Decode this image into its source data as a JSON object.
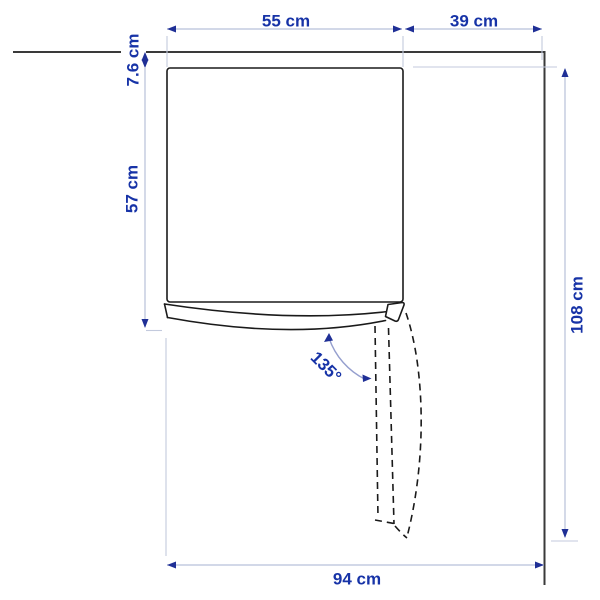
{
  "diagram": {
    "type": "appliance-top-view-dimension-drawing",
    "labels": {
      "body_width": "55 cm",
      "right_clearance": "39 cm",
      "wall_gap": "7.6 cm",
      "body_depth": "57 cm",
      "total_depth": "108 cm",
      "total_width": "94 cm",
      "door_opening_angle": "135°"
    },
    "colors": {
      "label_text": "#1733a7",
      "dimension_line": "#b7c0d9",
      "extension_line": "#c3cadd",
      "arrowhead": "#1f2f96",
      "drawing_line": "#1a1a1a",
      "wall_line": "#3a3a3a",
      "swing_arc": "#959fce",
      "background": "#ffffff"
    }
  }
}
